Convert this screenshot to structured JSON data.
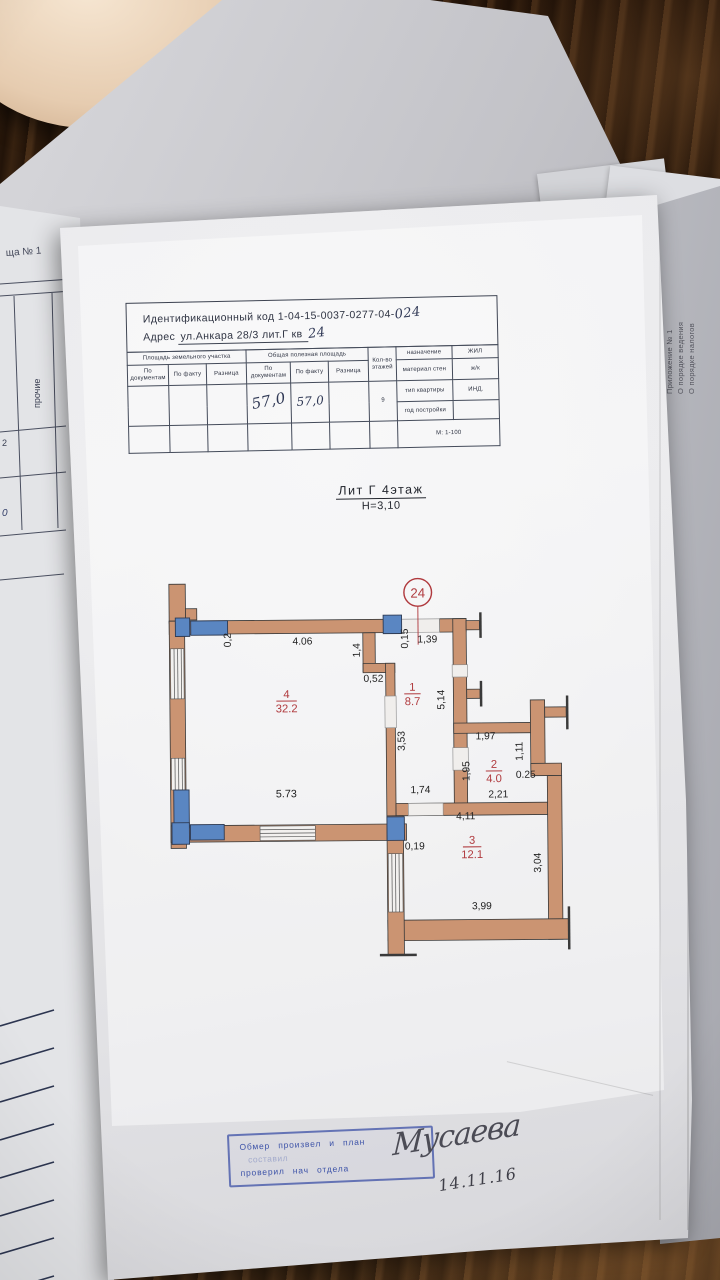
{
  "background": {
    "left_doc": {
      "page_label": "ща № 1",
      "column_label": "прочие",
      "cell_values": [
        "2",
        "0"
      ]
    },
    "right_doc": {
      "lines": [
        "Приложение № 1",
        "О порядке ведения",
        "О порядке налогов"
      ]
    }
  },
  "document": {
    "id_label": "Идентификационный код",
    "id_value": "1-04-15-0037-0277-04-",
    "id_handwritten": "024",
    "address_label": "Адрес",
    "address_value": "ул.Анкара 28/3 лит.Г кв",
    "address_handwritten": "24",
    "table": {
      "group_land": "Площадь земельного участка",
      "group_total": "Общая полезная площадь",
      "sub_doc": "По документам",
      "sub_fact": "По факту",
      "sub_diff": "Разница",
      "floors_label": "Кол-во этажей",
      "floors_value": "9",
      "total_doc_value": "57,0",
      "total_fact_value": "57,0",
      "right_rows": [
        {
          "label": "назначение",
          "value": "ЖИЛ"
        },
        {
          "label": "материал стен",
          "value": "ж/к"
        },
        {
          "label": "тип квартиры",
          "value": "ИНД."
        },
        {
          "label": "год постройки",
          "value": ""
        }
      ],
      "scale": "М: 1-100"
    },
    "plan_title": "Лит Г 4этаж",
    "plan_height_note": "Н=3,10",
    "plan": {
      "unit_number": "24",
      "colors": {
        "wall": "#cb9472",
        "window_block": "#5a86c2",
        "room_label": "#b03a3e",
        "stamp_ink": "#3d53a8"
      },
      "rooms": {
        "r1": {
          "num": "1",
          "area": "8.7"
        },
        "r2": {
          "num": "2",
          "area": "4.0"
        },
        "r3": {
          "num": "3",
          "area": "12.1"
        },
        "r4": {
          "num": "4",
          "area": "32.2"
        }
      },
      "dims": {
        "d406": "4.06",
        "d02": "0,2",
        "d14": "1,4",
        "d052": "0,52",
        "d015": "0,15",
        "d139": "1,39",
        "d514": "5,14",
        "d353": "3,53",
        "d174": "1,74",
        "d197": "1,97",
        "d111": "1,11",
        "d195": "1,95",
        "d025": "0.25",
        "d221": "2,21",
        "d411": "4,11",
        "d019": "0,19",
        "d304": "3,04",
        "d399": "3,99",
        "d573": "5.73"
      }
    },
    "stamp": {
      "line1": "Обмер произвел и план",
      "line2": "составил",
      "line3": "проверил нач отдела"
    },
    "signature": "Мусаева",
    "date": "14.11.16"
  }
}
